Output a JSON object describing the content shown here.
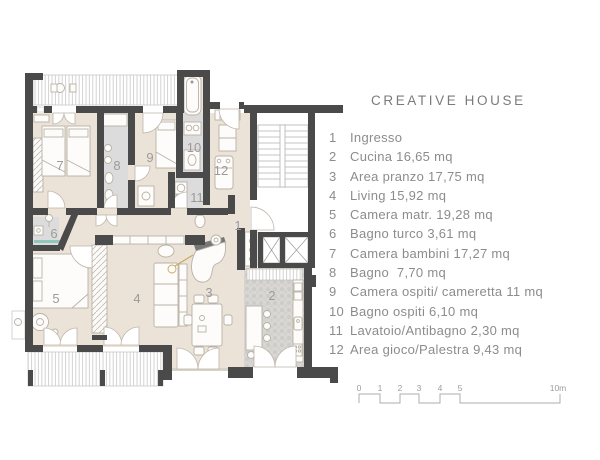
{
  "title": "CREATIVE HOUSE",
  "legend": {
    "items": [
      {
        "num": "1",
        "label": "Ingresso"
      },
      {
        "num": "2",
        "label": "Cucina 16,65 mq"
      },
      {
        "num": "3",
        "label": "Area pranzo 17,75 mq"
      },
      {
        "num": "4",
        "label": "Living 15,92 mq"
      },
      {
        "num": "5",
        "label": "Camera matr. 19,28 mq"
      },
      {
        "num": "6",
        "label": "Bagno turco 3,61 mq"
      },
      {
        "num": "7",
        "label": "Camera bambini 17,27 mq"
      },
      {
        "num": "8",
        "label": "Bagno  7,70 mq"
      },
      {
        "num": "9",
        "label": "Camera ospiti/ cameretta 11 mq"
      },
      {
        "num": "10",
        "label": "Bagno ospiti 6,10 mq"
      },
      {
        "num": "11",
        "label": "Lavatoio/Antibagno 2,30 mq"
      },
      {
        "num": "12",
        "label": "Area gioco/Palestra 9,43 mq"
      }
    ]
  },
  "plan": {
    "rooms": [
      {
        "number": "1"
      },
      {
        "number": "2"
      },
      {
        "number": "3"
      },
      {
        "number": "4"
      },
      {
        "number": "5"
      },
      {
        "number": "6"
      },
      {
        "number": "7"
      },
      {
        "number": "8"
      },
      {
        "number": "9"
      },
      {
        "number": "10"
      },
      {
        "number": "11"
      },
      {
        "number": "12"
      }
    ]
  },
  "scalebar": {
    "labels": [
      "0",
      "1",
      "2",
      "3",
      "4",
      "5",
      "10m"
    ]
  },
  "colors": {
    "wall": "#4a4a4a",
    "floor": "#ece3d8",
    "bath_floor": "#dcdcdc",
    "kitchen_floor": "#d8d7d3",
    "hatch_line": "#c8c8c8",
    "furniture_stroke": "#b9b1a6",
    "accent_gold": "#c9a85f",
    "accent_teal": "#8fc7b8",
    "legend_text": "#8c8c8c",
    "room_number": "#9b9b9b"
  }
}
